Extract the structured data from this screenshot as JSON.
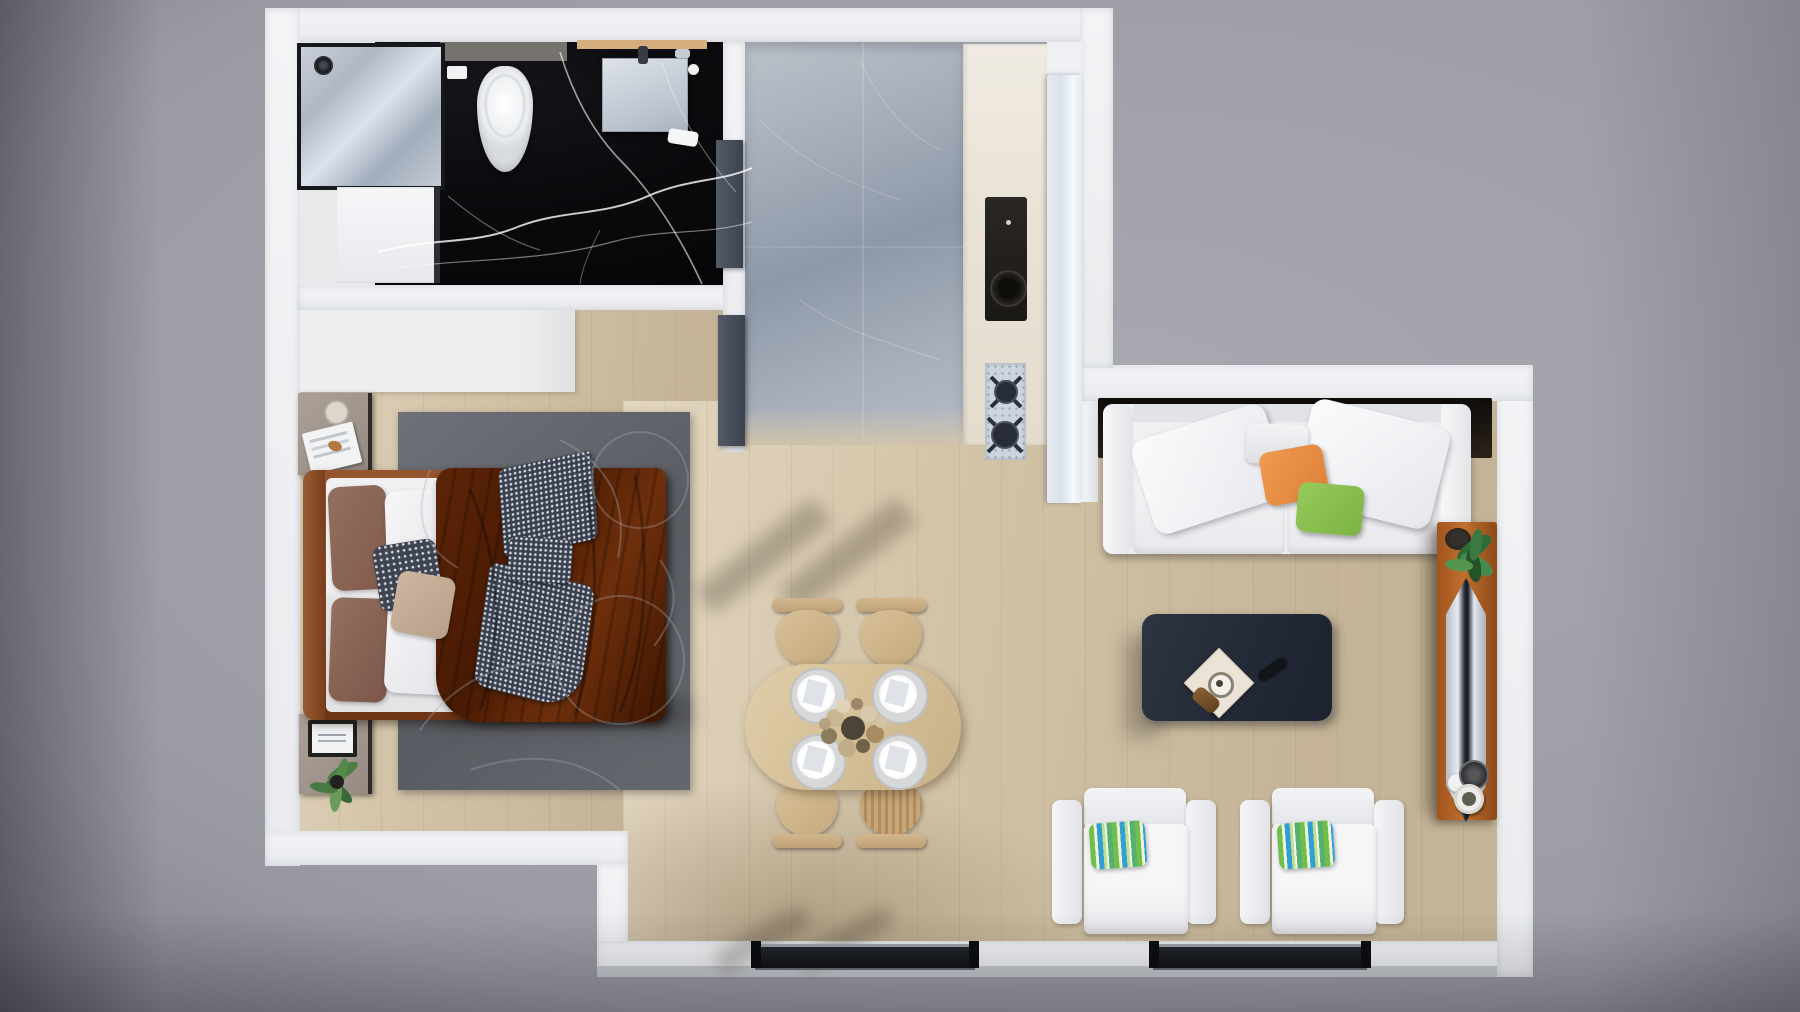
{
  "scene": {
    "kind": "apartment-floor-plan-3d-render",
    "view": "top-down",
    "label": "Furnished studio apartment floor plan render"
  },
  "palette": {
    "background_gray": "#9c9ca5",
    "wall_white": "#f1f2f5",
    "wood_floor": "#d3c4a8",
    "black_marble": "#0a0a0d",
    "gray_marble_tile": "#a3abb7",
    "rug_gray": "#63666c",
    "bed_frame_rust": "#83441f",
    "blanket_brown": "#4d1d05",
    "sofa_white": "#eff0f2",
    "accent_orange": "#e8914a",
    "accent_green": "#8cc152",
    "stripe_pillow": [
      "#6fbf4a",
      "#eef3d8",
      "#2f9fd6",
      "#bfe08e"
    ],
    "coffee_table_navy": "#232a37",
    "tv_console_terracotta": "#c06f2e",
    "dining_wood": "#d2bc93",
    "door_slate": "#454c58",
    "window_dark": "#15161b"
  },
  "rooms": {
    "bathroom": {
      "label": "bathroom",
      "floor": "black-marble"
    },
    "bedroom": {
      "label": "bedroom",
      "floor": "oak-wood"
    },
    "hallway": {
      "label": "hallway",
      "floor": "gray-marble-tile"
    },
    "kitchen": {
      "label": "kitchenette",
      "floor": "oak-wood"
    },
    "dining": {
      "label": "dining-area",
      "floor": "oak-wood"
    },
    "living": {
      "label": "living-room",
      "floor": "oak-wood"
    }
  },
  "furniture": {
    "bathroom": [
      "shower",
      "washing-machine",
      "toilet",
      "vanity-sink",
      "towel",
      "bathroom-door"
    ],
    "bedroom": [
      "double-bed",
      "brown-blanket",
      "houndstooth-throw",
      "pillows",
      "nightstand-with-magazines",
      "nightstand-with-tablet",
      "potted-plant",
      "area-rug",
      "wardrobe",
      "bedroom-door"
    ],
    "kitchen": [
      "counter",
      "sink",
      "gas-stove",
      "island-counter"
    ],
    "dining": [
      "oval-dining-table",
      "four-chairs",
      "four-place-settings",
      "dried-flower-centerpiece"
    ],
    "living": [
      "white-sofa",
      "orange-pillow",
      "green-pillow",
      "coffee-table",
      "serving-tray",
      "remote",
      "two-armchairs",
      "striped-pillows",
      "tv-console",
      "television",
      "monstera-plant",
      "vases",
      "two-windows"
    ]
  }
}
